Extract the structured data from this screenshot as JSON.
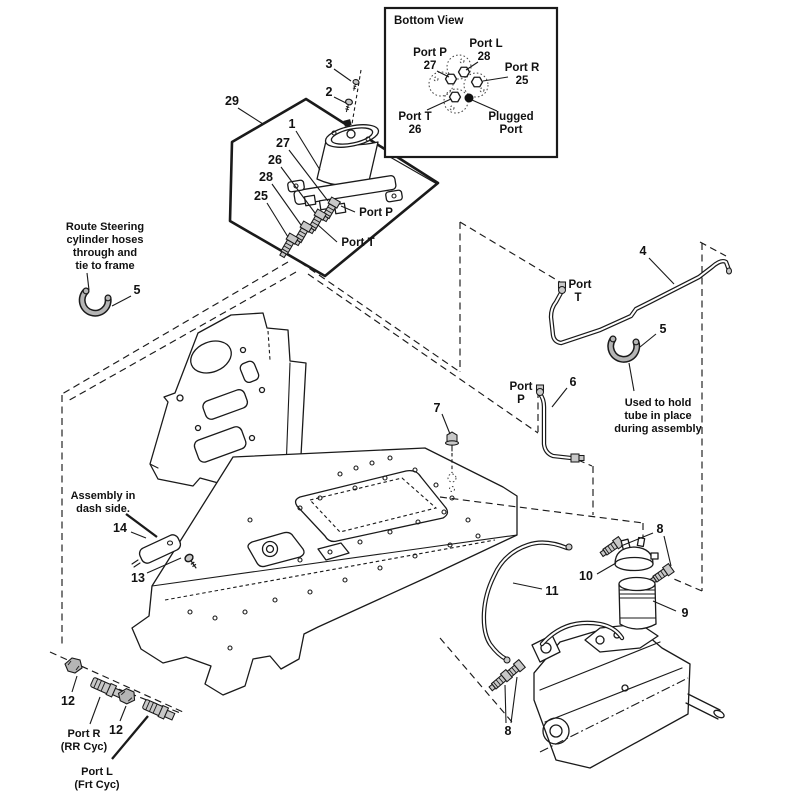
{
  "inset": {
    "title": "Bottom View",
    "port_p": {
      "name": "Port P",
      "num": "27"
    },
    "port_l": {
      "name": "Port L",
      "num": "28"
    },
    "port_r": {
      "name": "Port R",
      "num": "25"
    },
    "port_t": {
      "name": "Port T",
      "num": "26"
    },
    "plugged": {
      "line1": "Plugged",
      "line2": "Port"
    }
  },
  "numbers": {
    "1": "1",
    "2": "2",
    "3": "3",
    "4": "4",
    "5": "5",
    "6": "6",
    "7": "7",
    "8": "8",
    "9": "9",
    "10": "10",
    "11": "11",
    "12": "12",
    "13": "13",
    "14": "14",
    "25": "25",
    "26": "26",
    "27": "27",
    "28": "28",
    "29": "29"
  },
  "ports": {
    "valve_p": "Port P",
    "valve_t": "Port T",
    "tube_t": {
      "l1": "Port",
      "l2": "T"
    },
    "tube_p": {
      "l1": "Port",
      "l2": "P"
    }
  },
  "notes": {
    "route": [
      "Route Steering",
      "cylinder hoses",
      "through and",
      "tie to frame"
    ],
    "hold": [
      "Used to hold",
      "tube in place",
      "during assembly"
    ],
    "dash_side": [
      "Assembly in",
      "dash side."
    ],
    "port_r": [
      "Port R",
      "(RR Cyc)"
    ],
    "port_l": [
      "Port L",
      "(Frt Cyc)"
    ]
  }
}
